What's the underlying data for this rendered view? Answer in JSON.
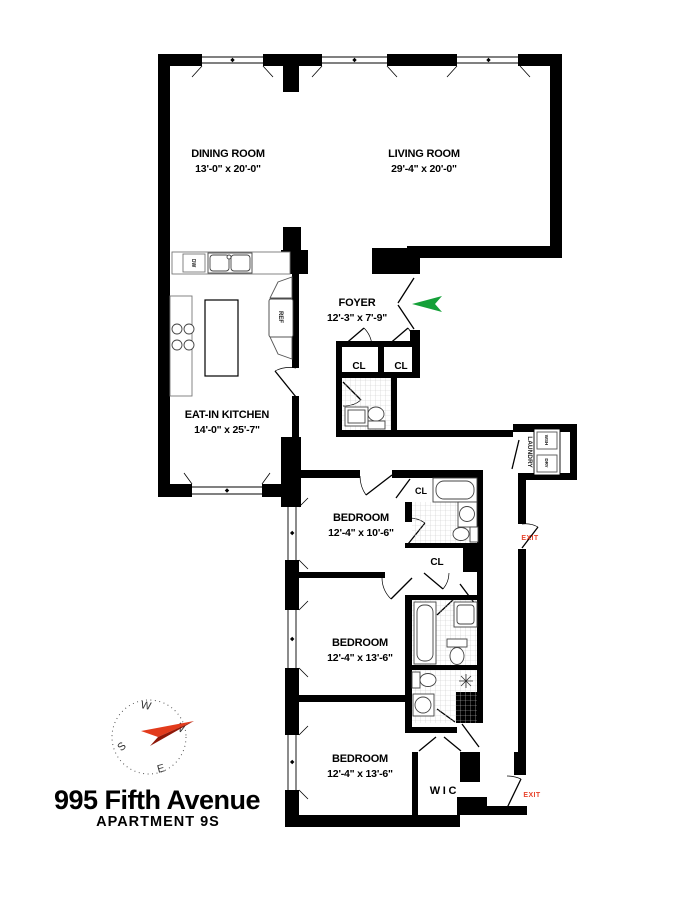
{
  "title": {
    "address": "995 Fifth Avenue",
    "unit": "APARTMENT 9S"
  },
  "rooms": {
    "dining": {
      "name": "DINING ROOM",
      "dims": "13'-0\" x 20'-0\""
    },
    "living": {
      "name": "LIVING ROOM",
      "dims": "29'-4\" x 20'-0\""
    },
    "foyer": {
      "name": "FOYER",
      "dims": "12'-3\" x 7'-9\""
    },
    "kitchen": {
      "name": "EAT-IN KITCHEN",
      "dims": "14'-0\" x 25'-7\""
    },
    "bedroom1": {
      "name": "BEDROOM",
      "dims": "12'-4\" x 10'-6\""
    },
    "bedroom2": {
      "name": "BEDROOM",
      "dims": "12'-4\" x 13'-6\""
    },
    "bedroom3": {
      "name": "BEDROOM",
      "dims": "12'-4\" x 13'-6\""
    },
    "wic": {
      "name": "W I C"
    }
  },
  "labels": {
    "closet": "CL",
    "laundry": "LAUNDRY",
    "washer": "WSH",
    "dryer": "DRY",
    "refrigerator": "REF",
    "dishwasher": "DW",
    "exit": "EXIT"
  },
  "compass": {
    "north": "N",
    "south": "S",
    "east": "E",
    "west": "W"
  },
  "colors": {
    "wall": "#000000",
    "entry_arrow": "#14a038",
    "exit_text": "#e8432b",
    "needle_light": "#e23b1c",
    "needle_dark": "#8e1708"
  }
}
